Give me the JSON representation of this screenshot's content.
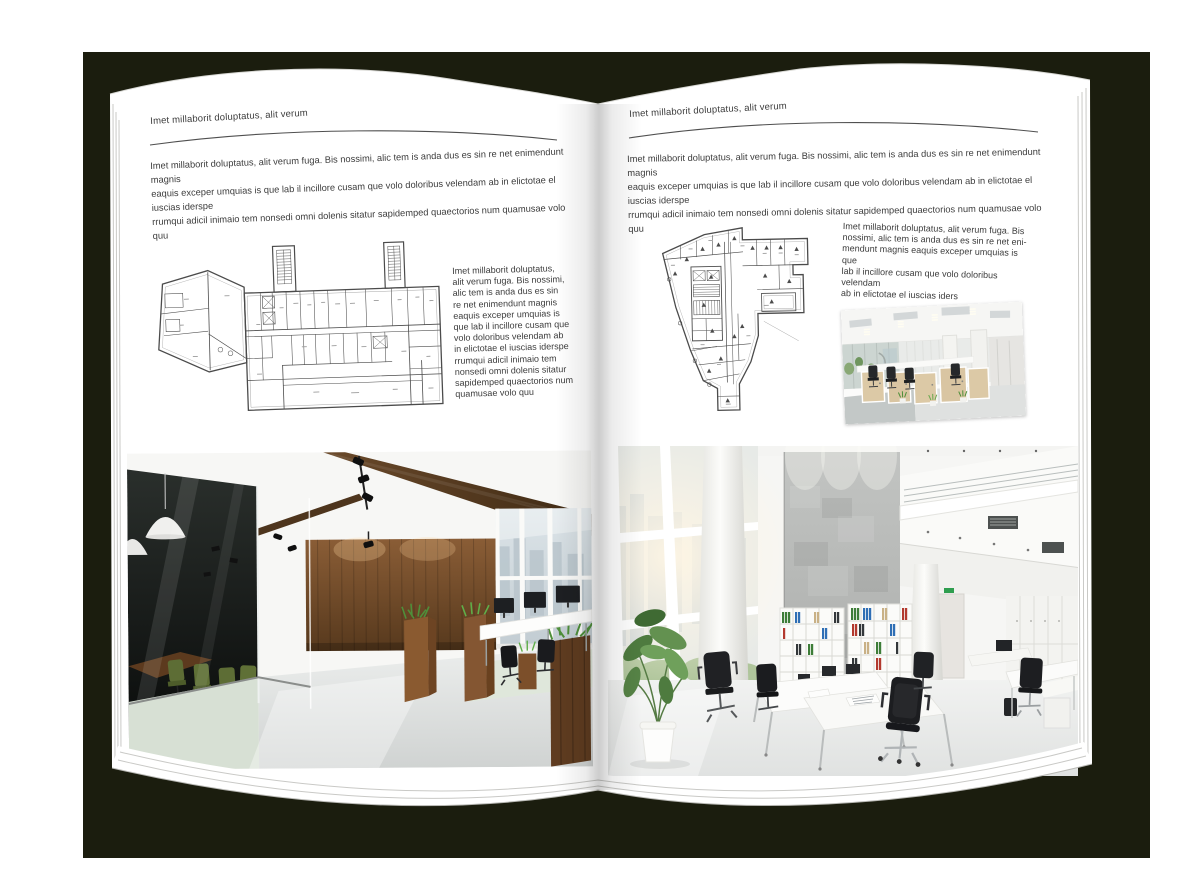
{
  "left_page": {
    "header": "Imet millaborit doluptatus, alit verum",
    "intro": "Imet millaborit doluptatus, alit verum fuga. Bis nossimi, alic tem is anda dus es sin re net enimendunt magnis\neaquis exceper umquias is que lab il incillore cusam que volo doloribus velendam ab in elictotae el iuscias iderspe\nrrumqui adicil inimaio tem nonsedi omni dolenis sitatur sapidemped quaectorios num quamusae volo quu",
    "sidebar": "Imet millaborit doluptatus,\nalit verum fuga. Bis nossimi,\nalic tem is anda dus es sin\nre net enimendunt magnis\neaquis exceper umquias is\nque lab il incillore cusam que\nvolo doloribus velendam ab\nin elictotae el iuscias iderspe\nrrumqui adicil inimaio tem\nnonsedi omni dolenis sitatur\nsapidemped quaectorios num\nquamusae volo quu"
  },
  "right_page": {
    "header": "Imet millaborit doluptatus, alit verum",
    "intro": "Imet millaborit doluptatus, alit verum fuga. Bis nossimi, alic tem is anda dus es sin re net enimendunt magnis\neaquis exceper umquias is que lab il incillore cusam que volo doloribus velendam ab in elictotae el iuscias iderspe\nrrumqui adicil inimaio tem nonsedi omni dolenis sitatur sapidemped quaectorios num quamusae volo quu",
    "sidebar": "Imet millaborit doluptatus, alit verum fuga. Bis\nnossimi, alic tem is anda dus es sin re net eni-\nmendunt magnis eaquis exceper umquias is que\nlab il incillore cusam que volo doloribus velendam\nab in elictotae el iuscias iders"
  },
  "palette": {
    "backdrop": "#1b1d0e",
    "page": "#ffffff",
    "text": "#3c3c3c",
    "plan_line": "#4b4b4b",
    "wood": "#6e4a28",
    "plant_green": "#5b8a3c",
    "chair_green": "#5d6d35",
    "binder_green": "#3e7d38",
    "binder_blue": "#2f6fb5",
    "binder_red": "#b3392e"
  }
}
